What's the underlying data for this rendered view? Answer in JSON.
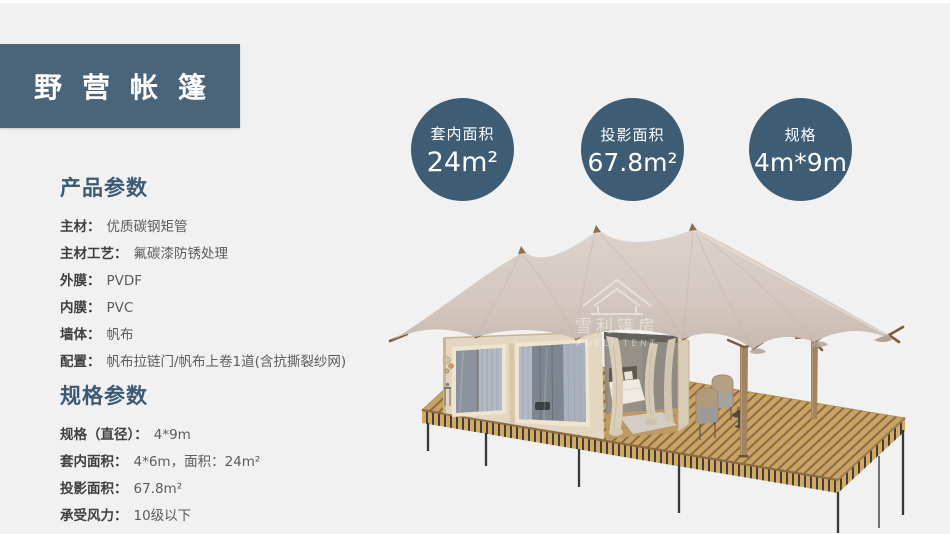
{
  "header": {
    "title": "野营帐篷"
  },
  "badges": [
    {
      "label": "套内面积",
      "value": "24m²"
    },
    {
      "label": "投影面积",
      "value": "67.8m²"
    },
    {
      "label": "规格",
      "value": "4m*9m"
    }
  ],
  "product_params": {
    "heading": "产品参数",
    "items": [
      {
        "label": "主材：",
        "value": "优质碳钢矩管"
      },
      {
        "label": "主材工艺：",
        "value": "氟碳漆防锈处理"
      },
      {
        "label": "外膜：",
        "value": "PVDF"
      },
      {
        "label": "内膜：",
        "value": "PVC"
      },
      {
        "label": "墙体：",
        "value": "帆布"
      },
      {
        "label": "配置：",
        "value": "帆布拉链门/帆布上卷1道(含抗撕裂纱网)"
      }
    ]
  },
  "spec_params": {
    "heading": "规格参数",
    "items": [
      {
        "label": "规格（直径）：",
        "value": "4*9m"
      },
      {
        "label": "套内面积：",
        "value": "4*6m，面积：24m²"
      },
      {
        "label": "投影面积：",
        "value": "67.8m²"
      },
      {
        "label": "承受风力：",
        "value": "10级以下"
      }
    ]
  },
  "watermark": {
    "name": "雪利篷房",
    "sub": "XUELI TENT"
  },
  "colors": {
    "page_bg": "#f1f1f2",
    "title_box_bg": "#4a6479",
    "badge_bg": "#3e5c73",
    "heading_text": "#3c5a72",
    "label_text": "#3f3f3f",
    "value_text": "#5c5c5c",
    "canopy_fabric": "#d6cbc3",
    "cabin_wall": "#e4d7c1",
    "deck_wood": "#c9a364",
    "metal_leg": "#35383d"
  }
}
